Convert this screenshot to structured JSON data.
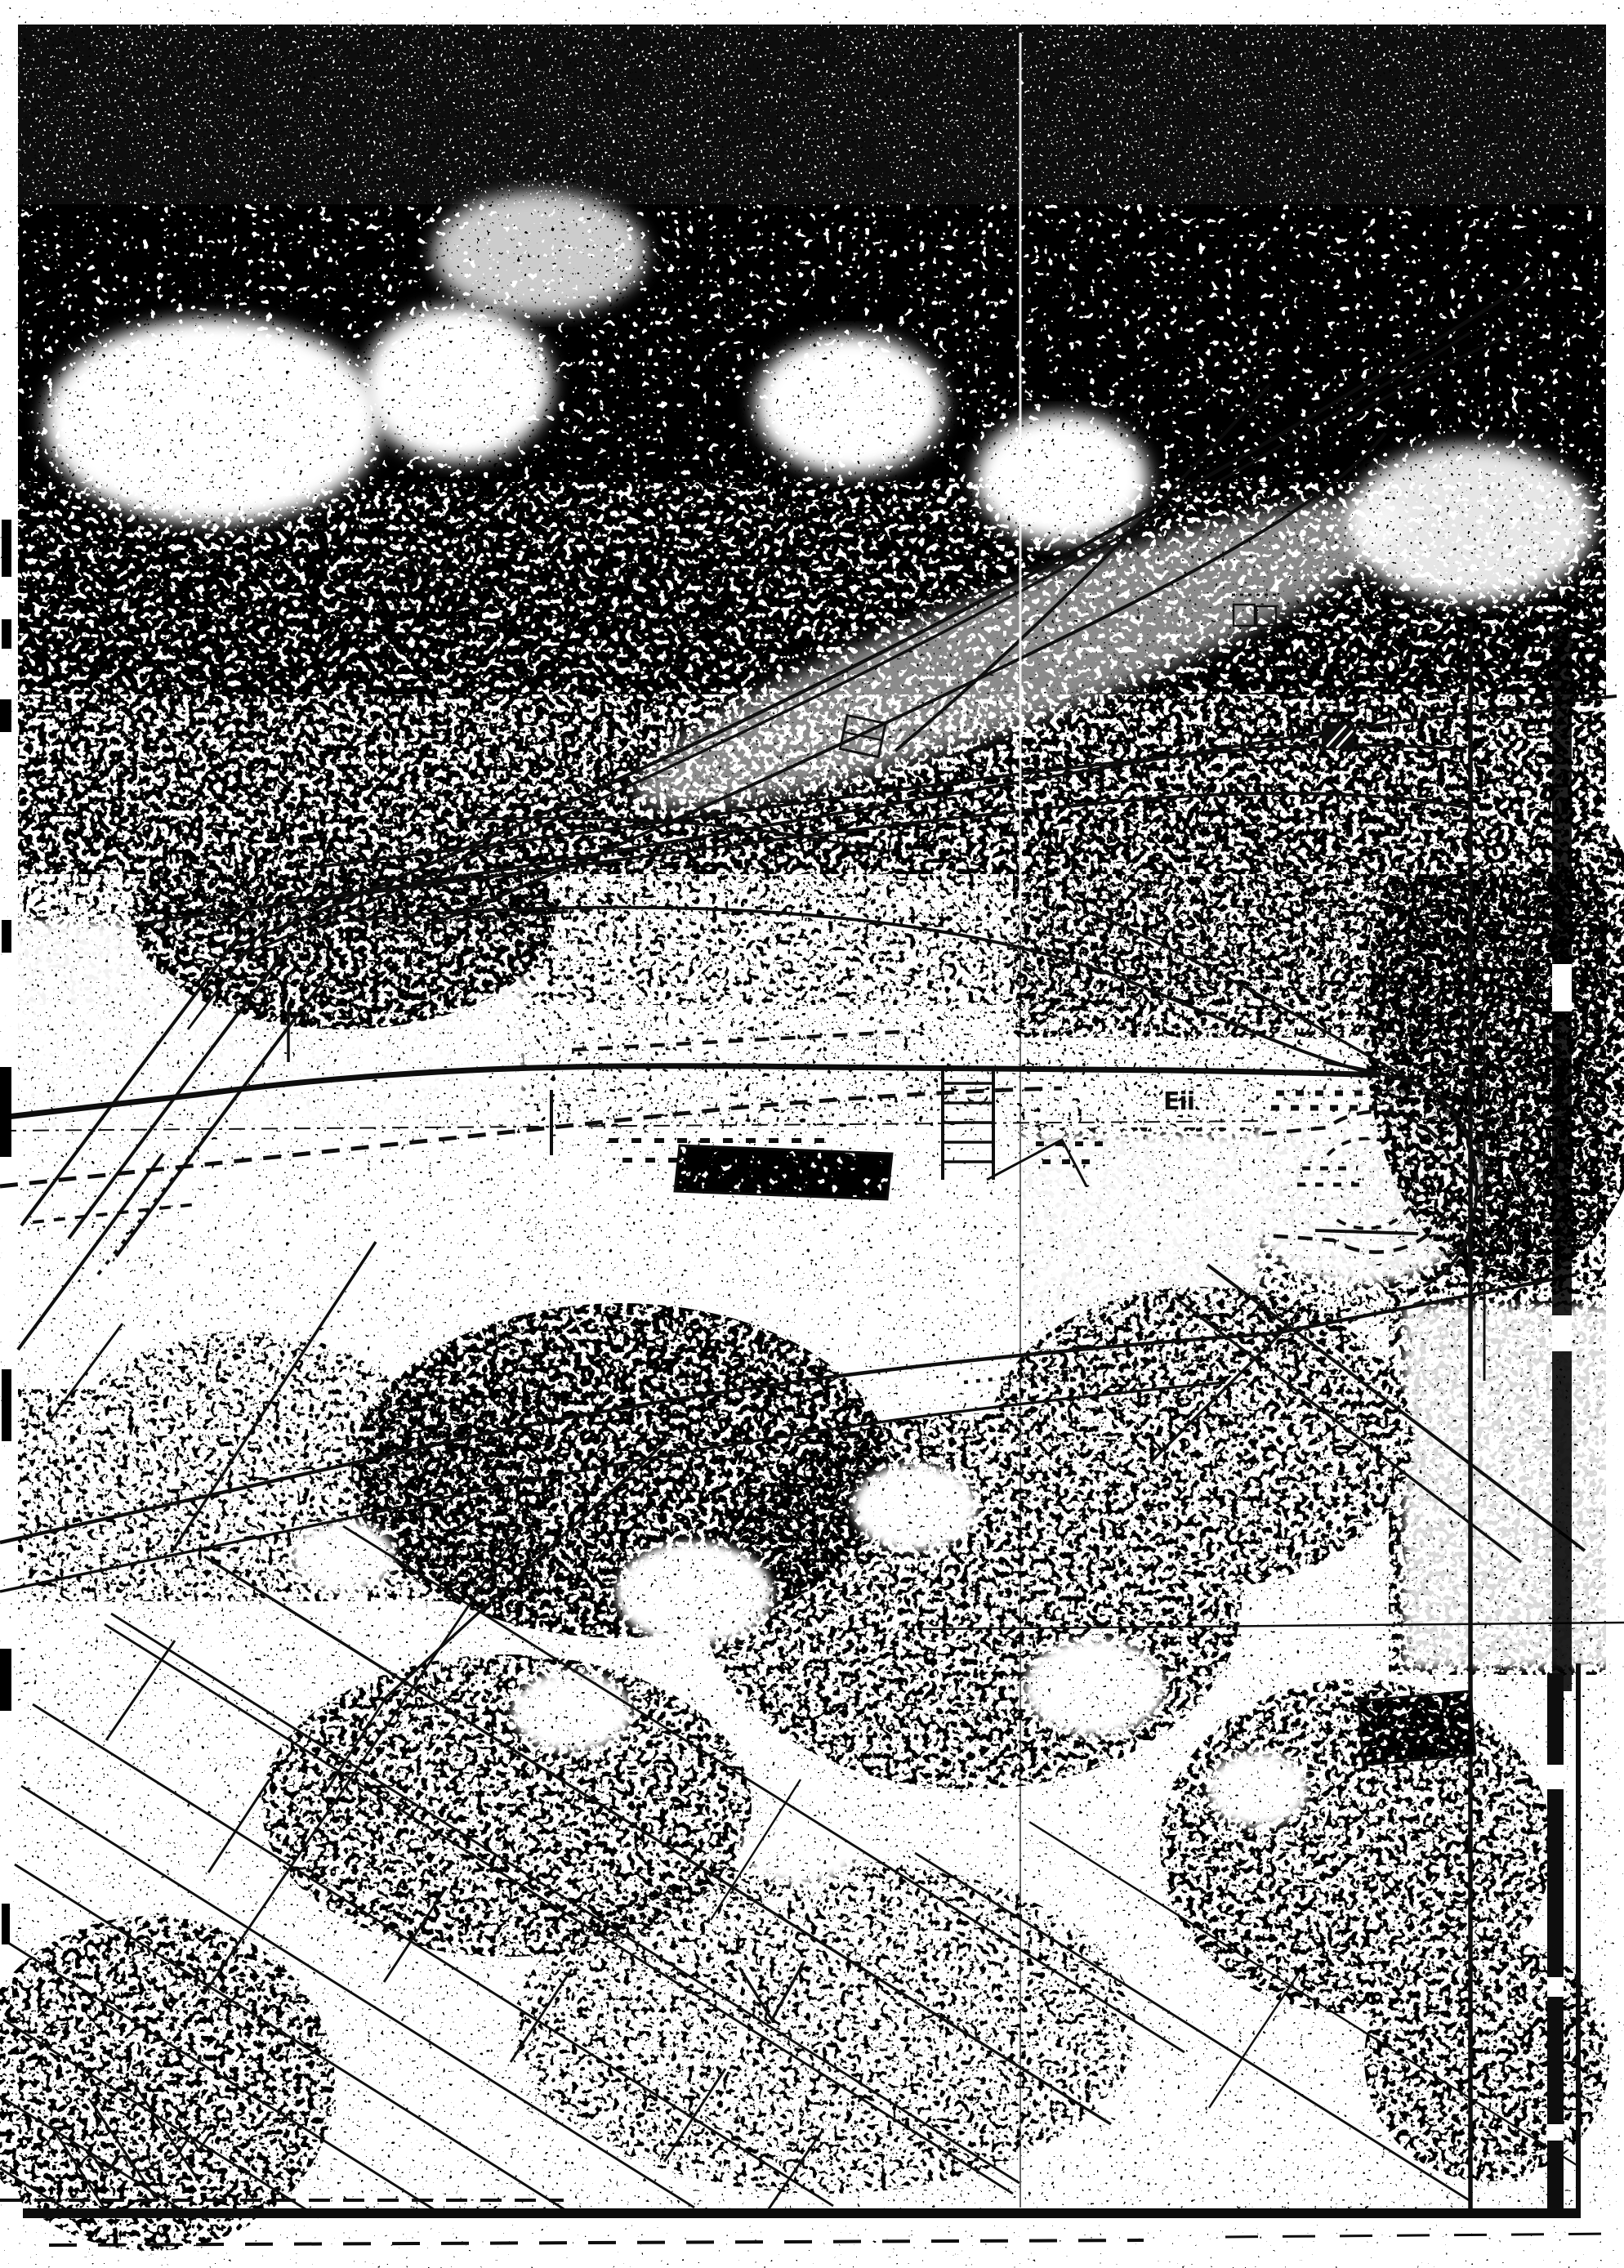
{
  "document": {
    "kind": "scanned-photocopy-map",
    "labels": {
      "track_label": "Eii"
    }
  },
  "colors": {
    "paper": "#ffffff",
    "ink": "#0d0d0d"
  },
  "features": [
    "photocopy-noise-texture",
    "dark-forest-halftone-band",
    "railway-curve-tracks",
    "railway-siding-lines",
    "main-track-line",
    "turning-loop-dashed",
    "hatched-building-footprint",
    "small-building-symbols",
    "field-parcel-boundaries",
    "access-road-line",
    "fold-crease-line",
    "scan-border-bottom",
    "scan-border-right",
    "handwritten-squiggle",
    "survey-circle-marks"
  ]
}
